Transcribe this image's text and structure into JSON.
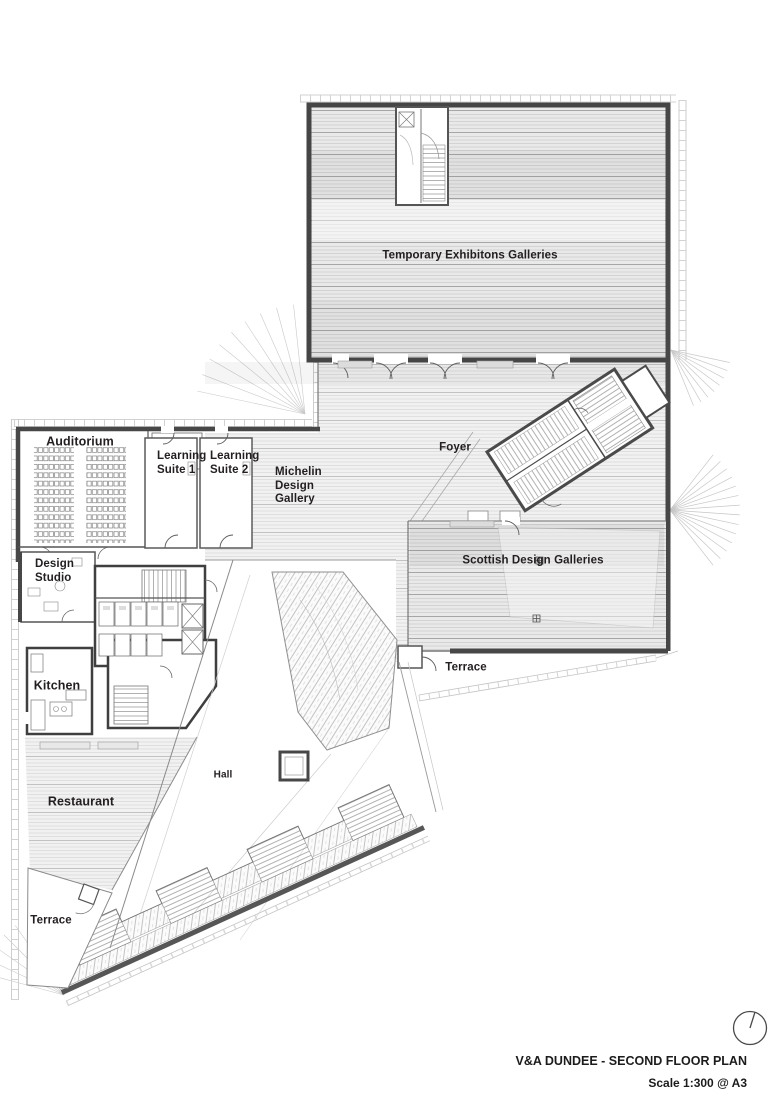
{
  "plan": {
    "name": "V&A DUNDEE - SECOND FLOOR PLAN",
    "scale": "Scale 1:300 @ A3",
    "colors": {
      "wall": "#474747",
      "floor_fill": "#ececec",
      "hatch_line": "#c9c9c9",
      "text": "#231f20",
      "background": "#ffffff"
    },
    "rooms": {
      "temporary_exhibitions": {
        "label": "Temporary Exhibitons Galleries"
      },
      "foyer": {
        "label": "Foyer"
      },
      "auditorium": {
        "label": "Auditorium"
      },
      "learning_suite_1": {
        "label": "Learning\nSuite 1"
      },
      "learning_suite_2": {
        "label": "Learning\nSuite 2"
      },
      "michelin_design_gallery": {
        "label": "Michelin\nDesign\nGallery"
      },
      "scottish_design_galleries": {
        "label": "Scottish Design Galleries"
      },
      "terrace_east": {
        "label": "Terrace"
      },
      "design_studio": {
        "label": "Design\nStudio"
      },
      "kitchen": {
        "label": "Kitchen"
      },
      "hall": {
        "label": "Hall"
      },
      "restaurant": {
        "label": "Restaurant"
      },
      "terrace_south": {
        "label": "Terrace"
      }
    }
  }
}
